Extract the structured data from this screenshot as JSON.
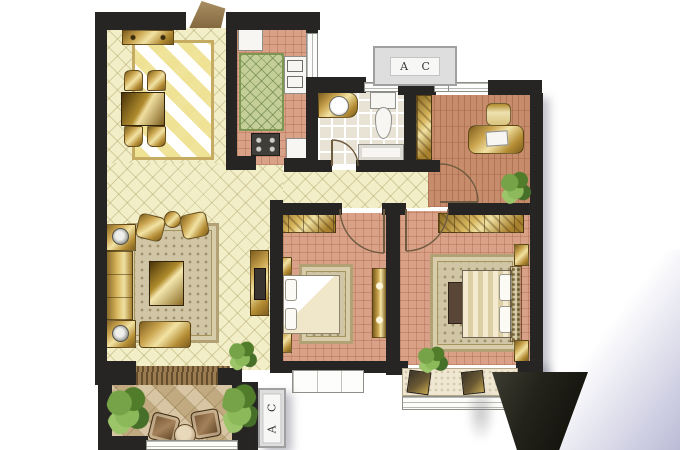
{
  "figure": {
    "kind": "apartment-floor-plan"
  },
  "ac_units": {
    "top": {
      "label": "A C"
    },
    "balcony": {
      "label": "A C"
    }
  },
  "palette": {
    "wall": "#262523",
    "floor_cream": "#f2eec8",
    "floor_terracotta": "#d9a187",
    "floor_study": "#c78c6b",
    "floor_bath": "#e9e3d6",
    "floor_balcony": "#cfb88f",
    "rug_beige": "#d0c5a4",
    "furniture_gold": "#caa44e",
    "plant_green": "#6d9a42",
    "corner_gradient": "#aaaacd",
    "wedge_dark": "#14140d"
  }
}
